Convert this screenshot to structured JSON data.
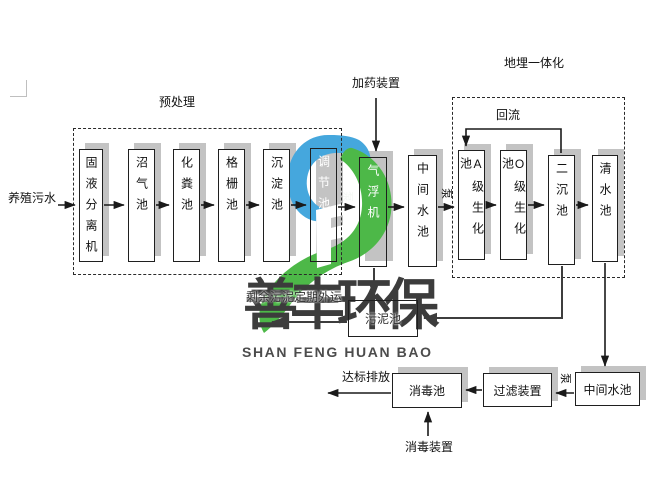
{
  "watermark": {
    "brand_cn": "善丰环保",
    "brand_en": "SHAN FENG HUAN BAO",
    "blue": "#45a7dd",
    "green": "#4db848",
    "text_color": "#3c3c3c"
  },
  "labels": {
    "influent": "养殖污水",
    "pretreatment": "预处理",
    "dosing_device": "加药装置",
    "buried_integration": "地埋一体化",
    "reflux": "回流",
    "pump": "泵",
    "sludge_note": "剩余污泥定期外运",
    "discharge": "达标排放",
    "disinfection_device": "消毒装置"
  },
  "boxes": {
    "separator": "固液分离机",
    "biogas": "沼气池",
    "septic": "化粪池",
    "grille": "格栅池",
    "sedimentation": "沉淀池",
    "regulating": "调节池",
    "air_flotation": "气浮机",
    "intermediate_top": "中间水池",
    "a_biochemical": "A级生化池",
    "o_biochemical": "O级生化池",
    "secondary_sedimentation": "二沉池",
    "clear_water": "清水池",
    "sludge": "污泥池",
    "disinfection": "消毒池",
    "filter": "过滤装置",
    "intermediate_bottom": "中间水池"
  }
}
